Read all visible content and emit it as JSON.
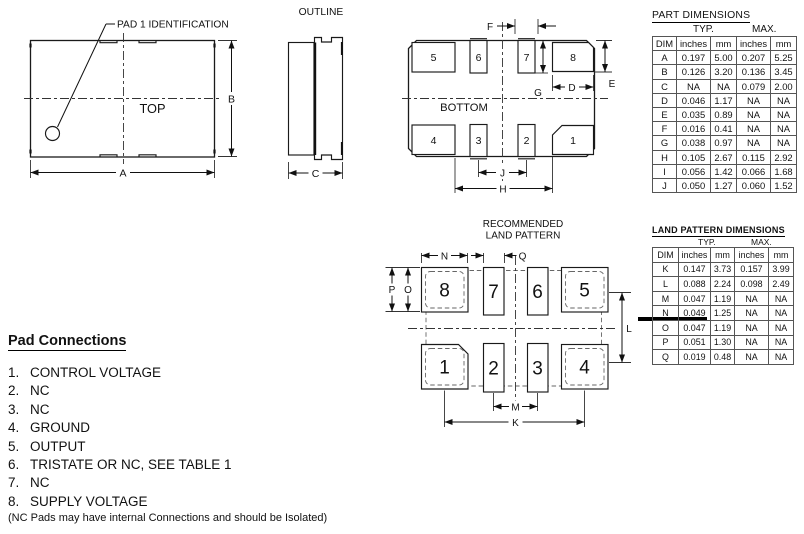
{
  "top_view": {
    "callout": "PAD 1 IDENTIFICATION",
    "label": "TOP",
    "dims": {
      "a": "A",
      "b": "B"
    }
  },
  "outline_view": {
    "title": "OUTLINE",
    "dims": {
      "c": "C"
    }
  },
  "bottom_view": {
    "label": "BOTTOM",
    "pads": {
      "p1": "1",
      "p2": "2",
      "p3": "3",
      "p4": "4",
      "p5": "5",
      "p6": "6",
      "p7": "7",
      "p8": "8"
    },
    "dims": {
      "d": "D",
      "e": "E",
      "f": "F",
      "g": "G",
      "h": "H",
      "j": "J"
    }
  },
  "land_pattern": {
    "title_line1": "RECOMMENDED",
    "title_line2": "LAND PATTERN",
    "pads": {
      "p1": "1",
      "p2": "2",
      "p3": "3",
      "p4": "4",
      "p5": "5",
      "p6": "6",
      "p7": "7",
      "p8": "8"
    },
    "dims": {
      "k": "K",
      "l": "L",
      "m": "M",
      "n": "N",
      "o": "O",
      "p": "P",
      "q": "Q"
    }
  },
  "part_table": {
    "title": "PART DIMENSIONS",
    "group_headers": [
      "TYP.",
      "MAX."
    ],
    "col_headers": [
      "DIM",
      "inches",
      "mm",
      "inches",
      "mm"
    ],
    "rows": [
      [
        "A",
        "0.197",
        "5.00",
        "0.207",
        "5.25"
      ],
      [
        "B",
        "0.126",
        "3.20",
        "0.136",
        "3.45"
      ],
      [
        "C",
        "NA",
        "NA",
        "0.079",
        "2.00"
      ],
      [
        "D",
        "0.046",
        "1.17",
        "NA",
        "NA"
      ],
      [
        "E",
        "0.035",
        "0.89",
        "NA",
        "NA"
      ],
      [
        "F",
        "0.016",
        "0.41",
        "NA",
        "NA"
      ],
      [
        "G",
        "0.038",
        "0.97",
        "NA",
        "NA"
      ],
      [
        "H",
        "0.105",
        "2.67",
        "0.115",
        "2.92"
      ],
      [
        "I",
        "0.056",
        "1.42",
        "0.066",
        "1.68"
      ],
      [
        "J",
        "0.050",
        "1.27",
        "0.060",
        "1.52"
      ]
    ]
  },
  "land_table": {
    "title": "LAND PATTERN DIMENSIONS",
    "group_headers": [
      "TYP.",
      "MAX."
    ],
    "col_headers": [
      "DIM",
      "inches",
      "mm",
      "inches",
      "mm"
    ],
    "rows": [
      [
        "K",
        "0.147",
        "3.73",
        "0.157",
        "3.99"
      ],
      [
        "L",
        "0.088",
        "2.24",
        "0.098",
        "2.49"
      ],
      [
        "M",
        "0.047",
        "1.19",
        "NA",
        "NA"
      ],
      [
        "N",
        "0.049",
        "1.25",
        "NA",
        "NA"
      ],
      [
        "O",
        "0.047",
        "1.19",
        "NA",
        "NA"
      ],
      [
        "P",
        "0.051",
        "1.30",
        "NA",
        "NA"
      ],
      [
        "Q",
        "0.019",
        "0.48",
        "NA",
        "NA"
      ]
    ]
  },
  "pad_connections": {
    "title": "Pad Connections",
    "items": [
      {
        "num": "1.",
        "label": "CONTROL VOLTAGE"
      },
      {
        "num": "2.",
        "label": "NC"
      },
      {
        "num": "3.",
        "label": "NC"
      },
      {
        "num": "4.",
        "label": "GROUND"
      },
      {
        "num": "5.",
        "label": "OUTPUT"
      },
      {
        "num": "6.",
        "label": "TRISTATE OR NC, SEE TABLE 1"
      },
      {
        "num": "7.",
        "label": "NC"
      },
      {
        "num": "8.",
        "label": "SUPPLY VOLTAGE"
      }
    ],
    "note": "(NC Pads may have internal Connections and should be Isolated)"
  }
}
